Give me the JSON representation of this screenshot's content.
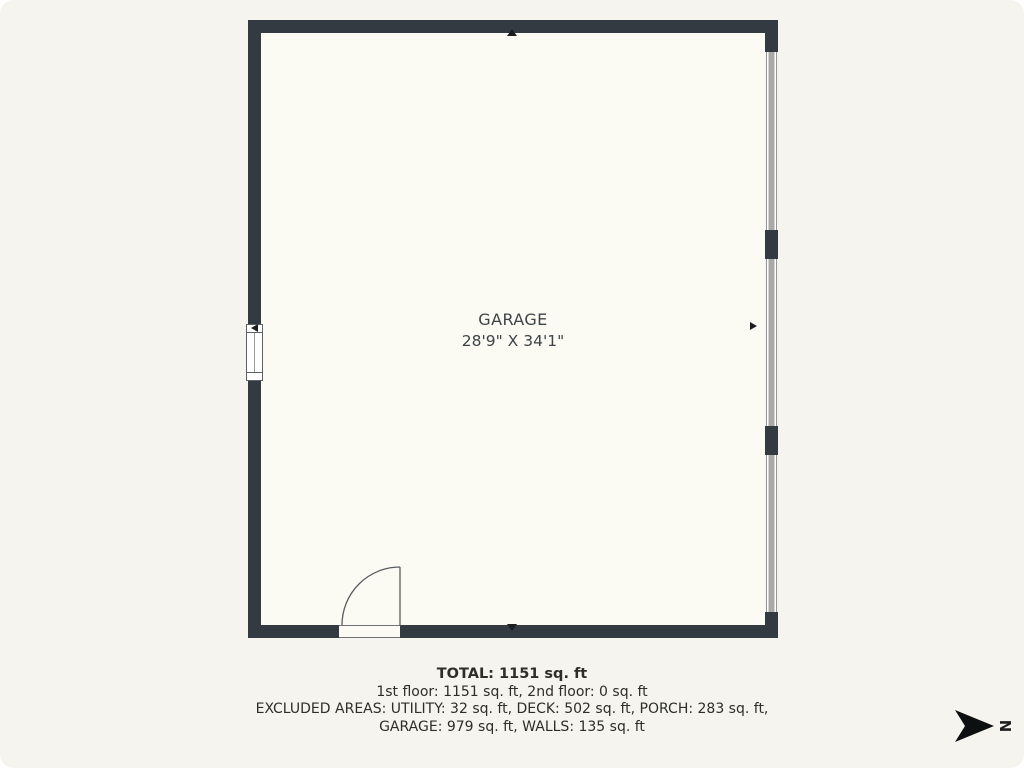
{
  "floorplan": {
    "room": {
      "name": "GARAGE",
      "dimensions": "28'9\" X 34'1\""
    },
    "summary": {
      "total": "TOTAL: 1151 sq. ft",
      "floors": "1st floor: 1151 sq. ft, 2nd floor: 0 sq. ft",
      "excluded_line1": "EXCLUDED AREAS: UTILITY: 32 sq. ft, DECK: 502 sq. ft, PORCH: 283 sq. ft,",
      "excluded_line2": "GARAGE: 979 sq. ft, WALLS: 135 sq. ft"
    },
    "compass": {
      "letter": "N"
    }
  },
  "colors": {
    "background": "#f5f4ee",
    "interior": "#fbfbf4",
    "wall": "#333a41",
    "window": "#a9a9a7"
  }
}
